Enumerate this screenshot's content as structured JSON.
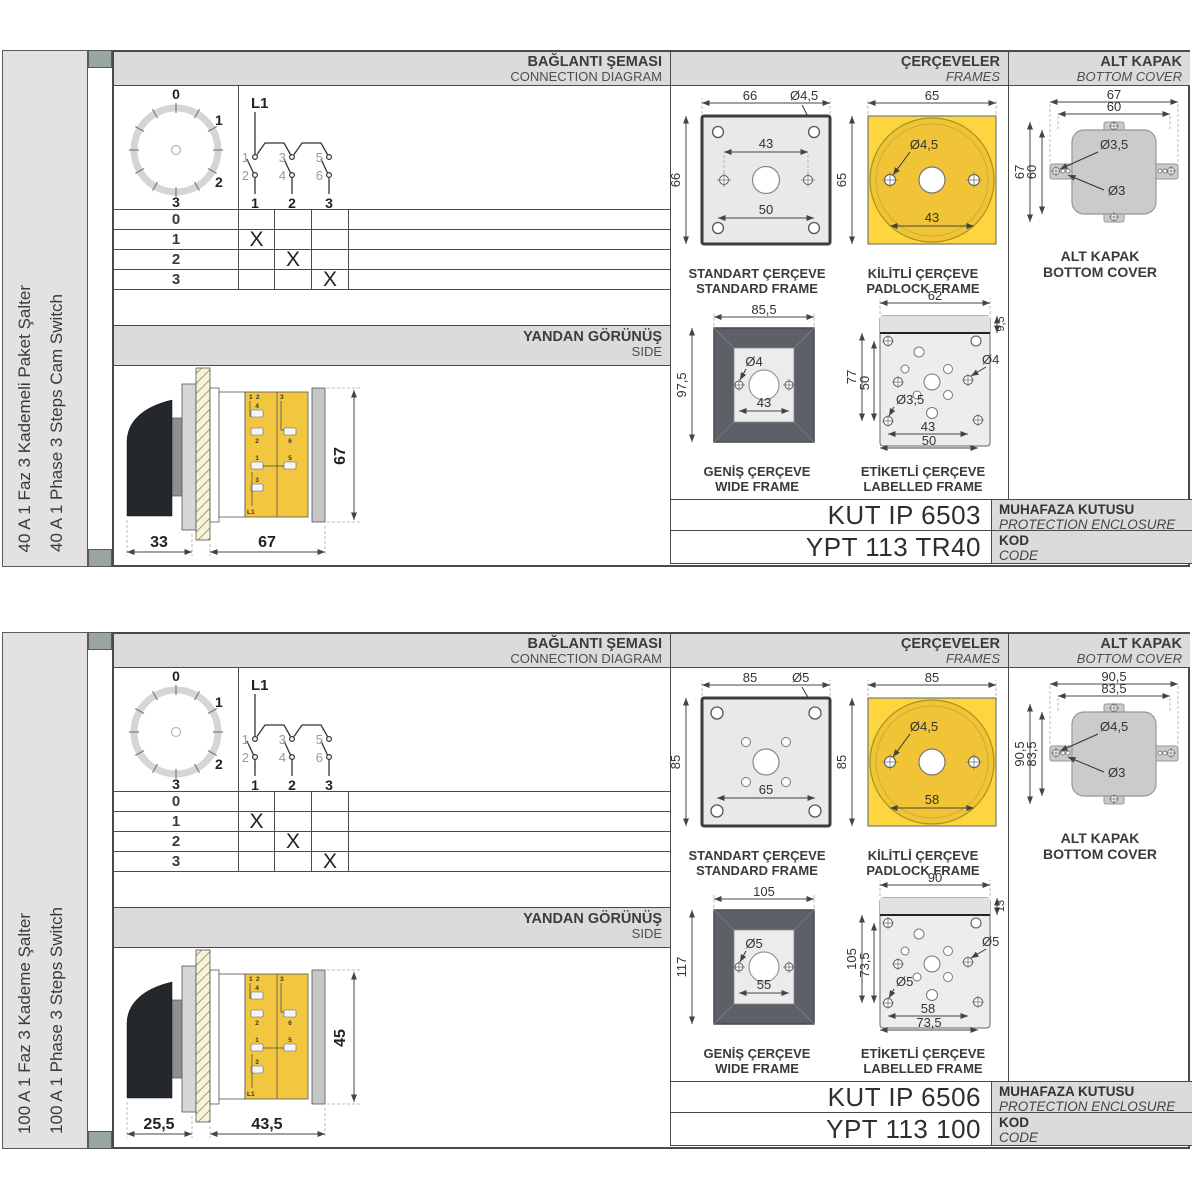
{
  "s": [
    {
      "side_label_tr": "40 A 1 Faz 3 Kademeli Paket Şalter",
      "side_label_en": "40 A 1 Phase 3 Steps Cam Switch",
      "hdr": {
        "conn_tr": "BAĞLANTI ŞEMASI",
        "conn_en": "CONNECTION DIAGRAM",
        "frames_tr": "ÇERÇEVELER",
        "frames_en": "FRAMES",
        "cover_tr": "ALT KAPAK",
        "cover_en": "BOTTOM COVER"
      },
      "dial": {
        "p0": "0",
        "p1": "1",
        "p2": "2",
        "p3": "3"
      },
      "circuit": {
        "feed": "L1",
        "t1": "1",
        "t2": "2",
        "t3": "3",
        "t4": "4",
        "t5": "5",
        "t6": "6",
        "o1": "1",
        "o2": "2",
        "o3": "3"
      },
      "table": {
        "rows": [
          [
            "0",
            "",
            "",
            ""
          ],
          [
            "1",
            "X",
            "",
            ""
          ],
          [
            "2",
            "",
            "X",
            ""
          ],
          [
            "3",
            "",
            "",
            "X"
          ]
        ]
      },
      "side": {
        "tr": "YANDAN GÖRÜNÜŞ",
        "en": "SIDE",
        "d1": "33",
        "d2": "67",
        "dh": "67"
      },
      "std": {
        "w": "66",
        "h": "66",
        "hole": "Ø4,5",
        "d_mid": "43",
        "d_bot": "50",
        "cap_tr": "STANDART ÇERÇEVE",
        "cap_en": "STANDARD FRAME"
      },
      "pad": {
        "w": "65",
        "h": "65",
        "hole": "Ø4,5",
        "d1": "43",
        "cap_tr": "KİLİTLİ ÇERÇEVE",
        "cap_en": "PADLOCK FRAME"
      },
      "wide": {
        "w": "85,5",
        "h": "97,5",
        "hole": "Ø4",
        "d1": "43",
        "cap_tr": "GENİŞ ÇERÇEVE",
        "cap_en": "WIDE FRAME"
      },
      "lbl": {
        "w": "62",
        "band": "9,5",
        "h": "77",
        "h2": "50",
        "hole_r": "Ø4",
        "hole_l": "Ø3,5",
        "d1": "43",
        "d2": "50",
        "cap_tr": "ETİKETLİ ÇERÇEVE",
        "cap_en": "LABELLED FRAME"
      },
      "cover": {
        "w1": "67",
        "w2": "60",
        "h1": "67",
        "h2": "60",
        "hole1": "Ø3,5",
        "hole2": "Ø3",
        "cap_tr": "ALT KAPAK",
        "cap_en": "BOTTOM COVER"
      },
      "codes": {
        "enc_val": "KUT IP 6503",
        "enc_tr": "MUHAFAZA KUTUSU",
        "enc_en": "PROTECTION ENCLOSURE",
        "code_val": "YPT 113 TR40",
        "code_tr": "KOD",
        "code_en": "CODE"
      }
    },
    {
      "side_label_tr": "100 A 1 Faz 3 Kademe Şalter",
      "side_label_en": "100 A 1 Phase 3 Steps Switch",
      "hdr": {
        "conn_tr": "BAĞLANTI ŞEMASI",
        "conn_en": "CONNECTION DIAGRAM",
        "frames_tr": "ÇERÇEVELER",
        "frames_en": "FRAMES",
        "cover_tr": "ALT KAPAK",
        "cover_en": "BOTTOM COVER"
      },
      "dial": {
        "p0": "0",
        "p1": "1",
        "p2": "2",
        "p3": "3"
      },
      "circuit": {
        "feed": "L1",
        "t1": "1",
        "t2": "2",
        "t3": "3",
        "t4": "4",
        "t5": "5",
        "t6": "6",
        "o1": "1",
        "o2": "2",
        "o3": "3"
      },
      "table": {
        "rows": [
          [
            "0",
            "",
            "",
            ""
          ],
          [
            "1",
            "X",
            "",
            ""
          ],
          [
            "2",
            "",
            "X",
            ""
          ],
          [
            "3",
            "",
            "",
            "X"
          ]
        ]
      },
      "side": {
        "tr": "YANDAN GÖRÜNÜŞ",
        "en": "SIDE",
        "d1": "25,5",
        "d2": "43,5",
        "dh": "45"
      },
      "std": {
        "w": "85",
        "h": "85",
        "hole": "Ø5",
        "d_bot": "65",
        "cap_tr": "STANDART ÇERÇEVE",
        "cap_en": "STANDARD FRAME"
      },
      "pad": {
        "w": "85",
        "h": "85",
        "hole": "Ø4,5",
        "d1": "58",
        "cap_tr": "KİLİTLİ ÇERÇEVE",
        "cap_en": "PADLOCK FRAME"
      },
      "wide": {
        "w": "105",
        "h": "117",
        "hole": "Ø5",
        "d1": "55",
        "cap_tr": "GENİŞ ÇERÇEVE",
        "cap_en": "WIDE FRAME"
      },
      "lbl": {
        "w": "90",
        "band": "13",
        "h": "105",
        "h2": "73,5",
        "hole_r": "Ø5",
        "hole_l": "Ø5",
        "d1": "58",
        "d2": "73,5",
        "cap_tr": "ETİKETLİ ÇERÇEVE",
        "cap_en": "LABELLED FRAME"
      },
      "cover": {
        "w1": "90,5",
        "w2": "83,5",
        "h1": "90,5",
        "h2": "83,5",
        "hole1": "Ø4,5",
        "hole2": "Ø3",
        "cap_tr": "ALT KAPAK",
        "cap_en": "BOTTOM COVER"
      },
      "codes": {
        "enc_val": "KUT IP 6506",
        "enc_tr": "MUHAFAZA KUTUSU",
        "enc_en": "PROTECTION ENCLOSURE",
        "code_val": "YPT 113 100",
        "code_tr": "KOD",
        "code_en": "CODE"
      }
    }
  ]
}
